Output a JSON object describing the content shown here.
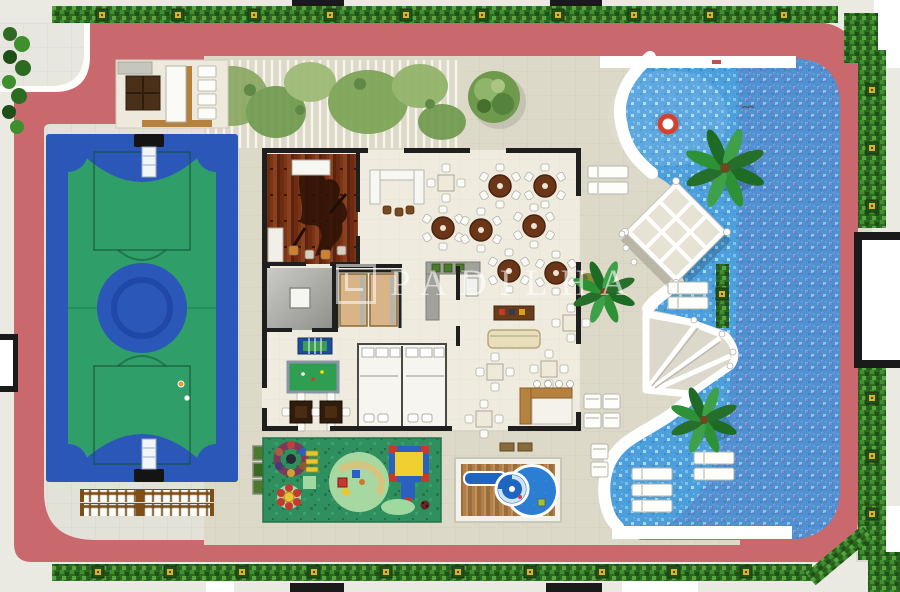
{
  "document": {
    "type": "architectural-floor-plan",
    "view": "top-down-amenity-deck-implantation"
  },
  "watermark": {
    "text": "PADILHA",
    "logo": "square-bracket-logo"
  },
  "palette": {
    "walkway_pink": "#c9686d",
    "hedge_green": "#2e6b22",
    "deck_beige": "#ddd9c8",
    "pad_gray": "#e2e2d8",
    "court_blue": "#2b58b8",
    "court_green": "#2f9e68",
    "pool_water": "#4d9fdc",
    "pool_deep_tint": "#5f50a0",
    "playground_green": "#2f8f5f",
    "kids_pool_blue": "#2a7fd4",
    "wood_brown": "#7c3416",
    "counter_wood": "#b5813f",
    "wall_black": "#1f1f1f",
    "white_structure": "#ffffff",
    "planter_pot_yellow": "#d7b32e",
    "life_ring_red": "#d6402e"
  },
  "features": [
    {
      "name": "perimeter-hedge-with-planters"
    },
    {
      "name": "pink-walkway"
    },
    {
      "name": "multi-sport-court"
    },
    {
      "name": "bleachers",
      "rows": 2
    },
    {
      "name": "grill-lounge-room"
    },
    {
      "name": "pergola-green-walkway"
    },
    {
      "name": "clubhouse-building",
      "rooms": [
        "pub-wood-lounge",
        "party-hall",
        "u-bar",
        "kitchen",
        "elevator-lobby",
        "fitness-room",
        "games-room",
        "restrooms",
        "sofa-lounge",
        "l-bar"
      ]
    },
    {
      "name": "party-hall-round-tables",
      "count": 7
    },
    {
      "name": "games-room-items",
      "items": [
        "foosball-table",
        "billiards-table",
        "card-tables"
      ]
    },
    {
      "name": "elevators",
      "count": 2
    },
    {
      "name": "swimming-pool",
      "elements": [
        "white-wavy-deck-edge",
        "diamond-lattice-pergola",
        "fan-pergola",
        "life-ring",
        "palm-trees",
        "in-pool-loungers",
        "pool-rims"
      ]
    },
    {
      "name": "in-pool-loungers",
      "count": 5
    },
    {
      "name": "sun-lounger-clusters",
      "count": 4
    },
    {
      "name": "kids-pool-with-spiral-slide"
    },
    {
      "name": "playground",
      "items": [
        "carousel",
        "spring-flower-toy",
        "climbing-bars",
        "play-circle",
        "platform-structure"
      ]
    }
  ]
}
